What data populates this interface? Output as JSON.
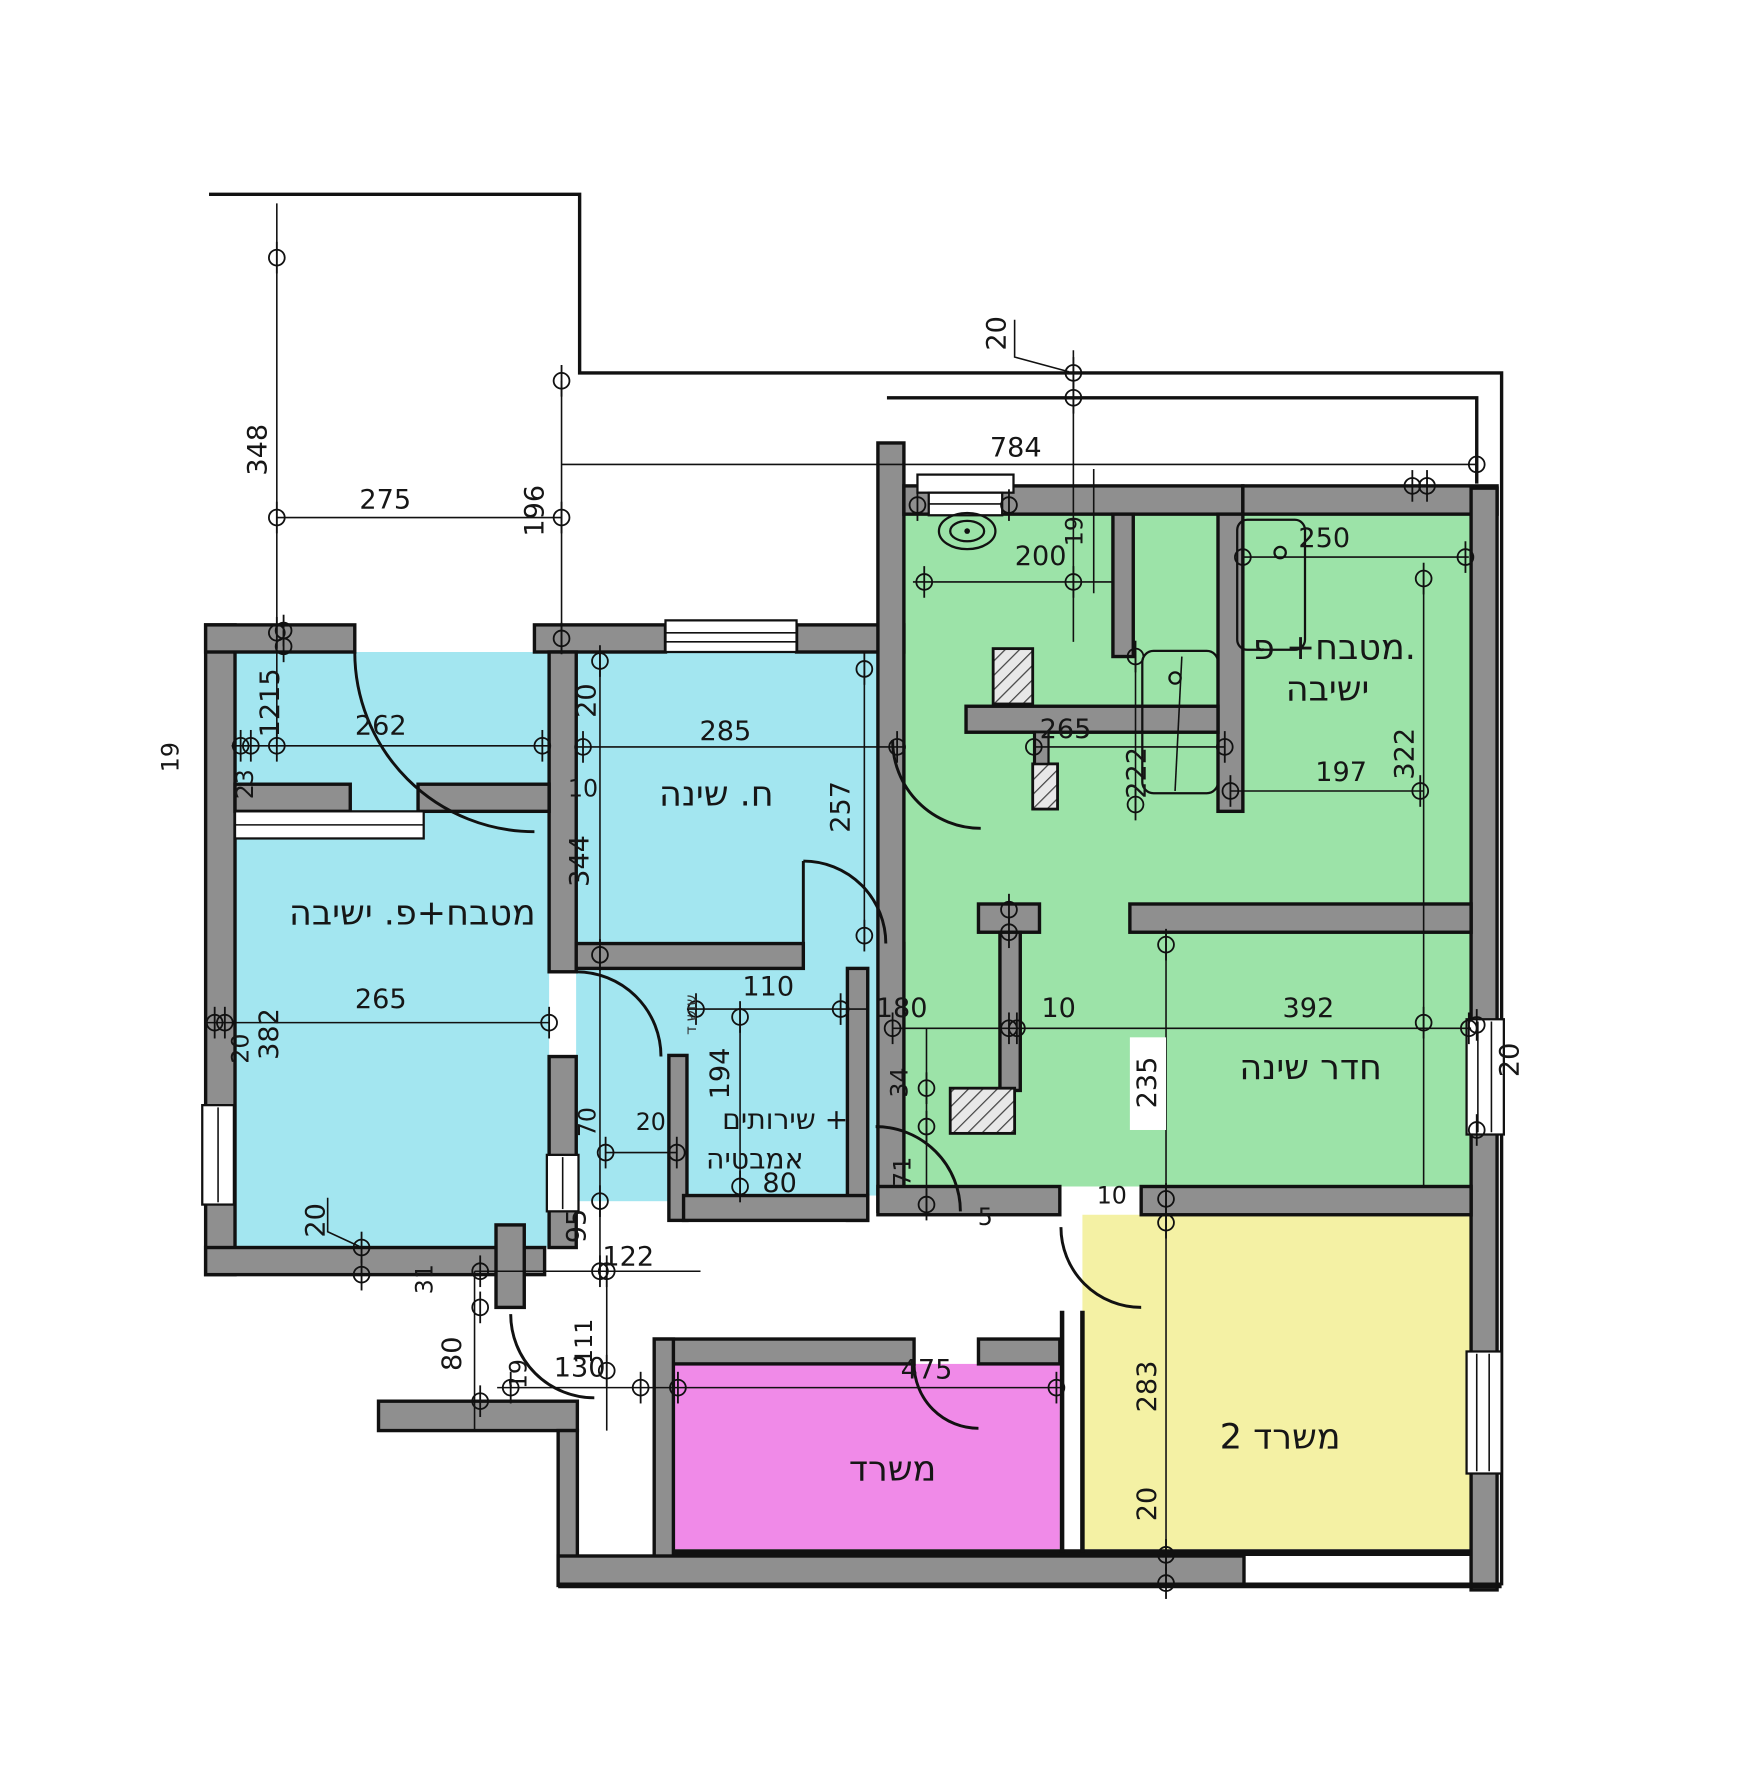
{
  "title": "Apartment floor plan (Hebrew, dimensioned)",
  "colors": {
    "cyan_room": "#a3e6f0",
    "green_room": "#9ce3a8",
    "magenta_room": "#f08ae8",
    "yellow_room": "#f4f1a4",
    "wall_gray": "#8f8f8f",
    "line": "#111111"
  },
  "rooms": [
    {
      "id": "kitchen-sitting-cyan",
      "label": "מטבח+פ. ישיבה"
    },
    {
      "id": "bedroom-cyan",
      "label": "ח. שינה"
    },
    {
      "id": "toilet-bath",
      "line1": "שירותים +",
      "line2": "אמבטיה"
    },
    {
      "id": "kitchen-sitting-green",
      "line1": "מטבח+ פ.",
      "line2": "ישיבה"
    },
    {
      "id": "bedroom-green",
      "label": "חדר שינה"
    },
    {
      "id": "office",
      "label": "משרד"
    },
    {
      "id": "office-2",
      "label": "משרד 2"
    }
  ],
  "dims": [
    {
      "text": "348"
    },
    {
      "text": "275"
    },
    {
      "text": "196"
    },
    {
      "text": "784"
    },
    {
      "text": "20"
    },
    {
      "text": "200"
    },
    {
      "text": "250"
    },
    {
      "text": "19"
    },
    {
      "text": "265"
    },
    {
      "text": "197"
    },
    {
      "text": "322"
    },
    {
      "text": "222"
    },
    {
      "text": "392"
    },
    {
      "text": "10"
    },
    {
      "text": "180"
    },
    {
      "text": "235"
    },
    {
      "text": "34"
    },
    {
      "text": "71"
    },
    {
      "text": "20"
    },
    {
      "text": "10"
    },
    {
      "text": "5"
    },
    {
      "text": "262"
    },
    {
      "text": "1215"
    },
    {
      "text": "19"
    },
    {
      "text": "23"
    },
    {
      "text": "20"
    },
    {
      "text": "285"
    },
    {
      "text": "10"
    },
    {
      "text": "344"
    },
    {
      "text": "257"
    },
    {
      "text": "265"
    },
    {
      "text": "382"
    },
    {
      "text": "20"
    },
    {
      "text": "20"
    },
    {
      "text": "31"
    },
    {
      "text": "70"
    },
    {
      "text": "20"
    },
    {
      "text": "110"
    },
    {
      "text": "194"
    },
    {
      "text": "80"
    },
    {
      "text": "95"
    },
    {
      "text": "122"
    },
    {
      "text": "80"
    },
    {
      "text": "19"
    },
    {
      "text": "130"
    },
    {
      "text": "111"
    },
    {
      "text": "475"
    },
    {
      "text": "283"
    },
    {
      "text": "20"
    },
    {
      "text": "10"
    },
    {
      "text": "שוש ד"
    }
  ]
}
